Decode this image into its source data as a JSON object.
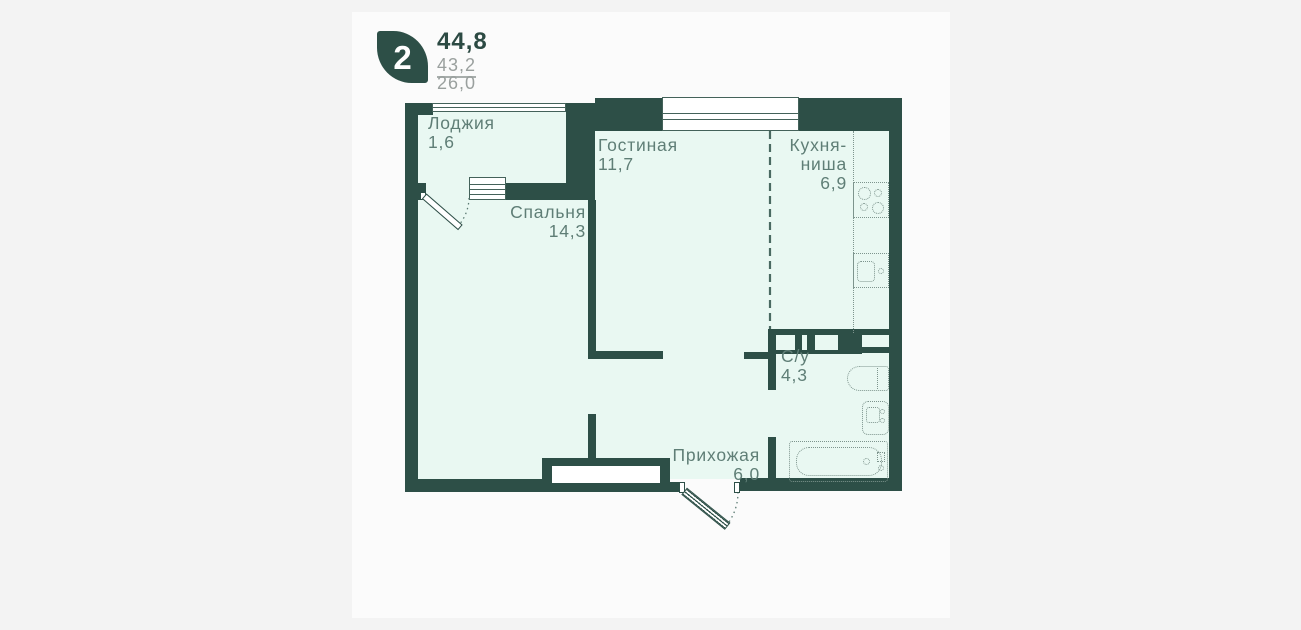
{
  "header": {
    "type_number": "2",
    "area_total": "44,8",
    "area_secondary": "43,2",
    "area_tertiary": "26,0"
  },
  "rooms": {
    "loggia": {
      "label": "Лоджия",
      "area": "1,6"
    },
    "living": {
      "label": "Гостиная",
      "area": "11,7"
    },
    "kitchen": {
      "line1": "Кухня-",
      "line2": "ниша",
      "area": "6,9"
    },
    "bedroom": {
      "label": "Спальня",
      "area": "14,3"
    },
    "bathroom": {
      "label": "С/у",
      "area": "4,3"
    },
    "hallway": {
      "label": "Прихожая",
      "area": "6,0"
    }
  },
  "colors": {
    "wall": "#2d4f47",
    "room_fill": "#e9f8f2",
    "label_text": "#5f7e76",
    "muted_text": "#9aa09e",
    "page_bg": "#f3f3f3",
    "panel_bg": "#fbfbfb"
  }
}
